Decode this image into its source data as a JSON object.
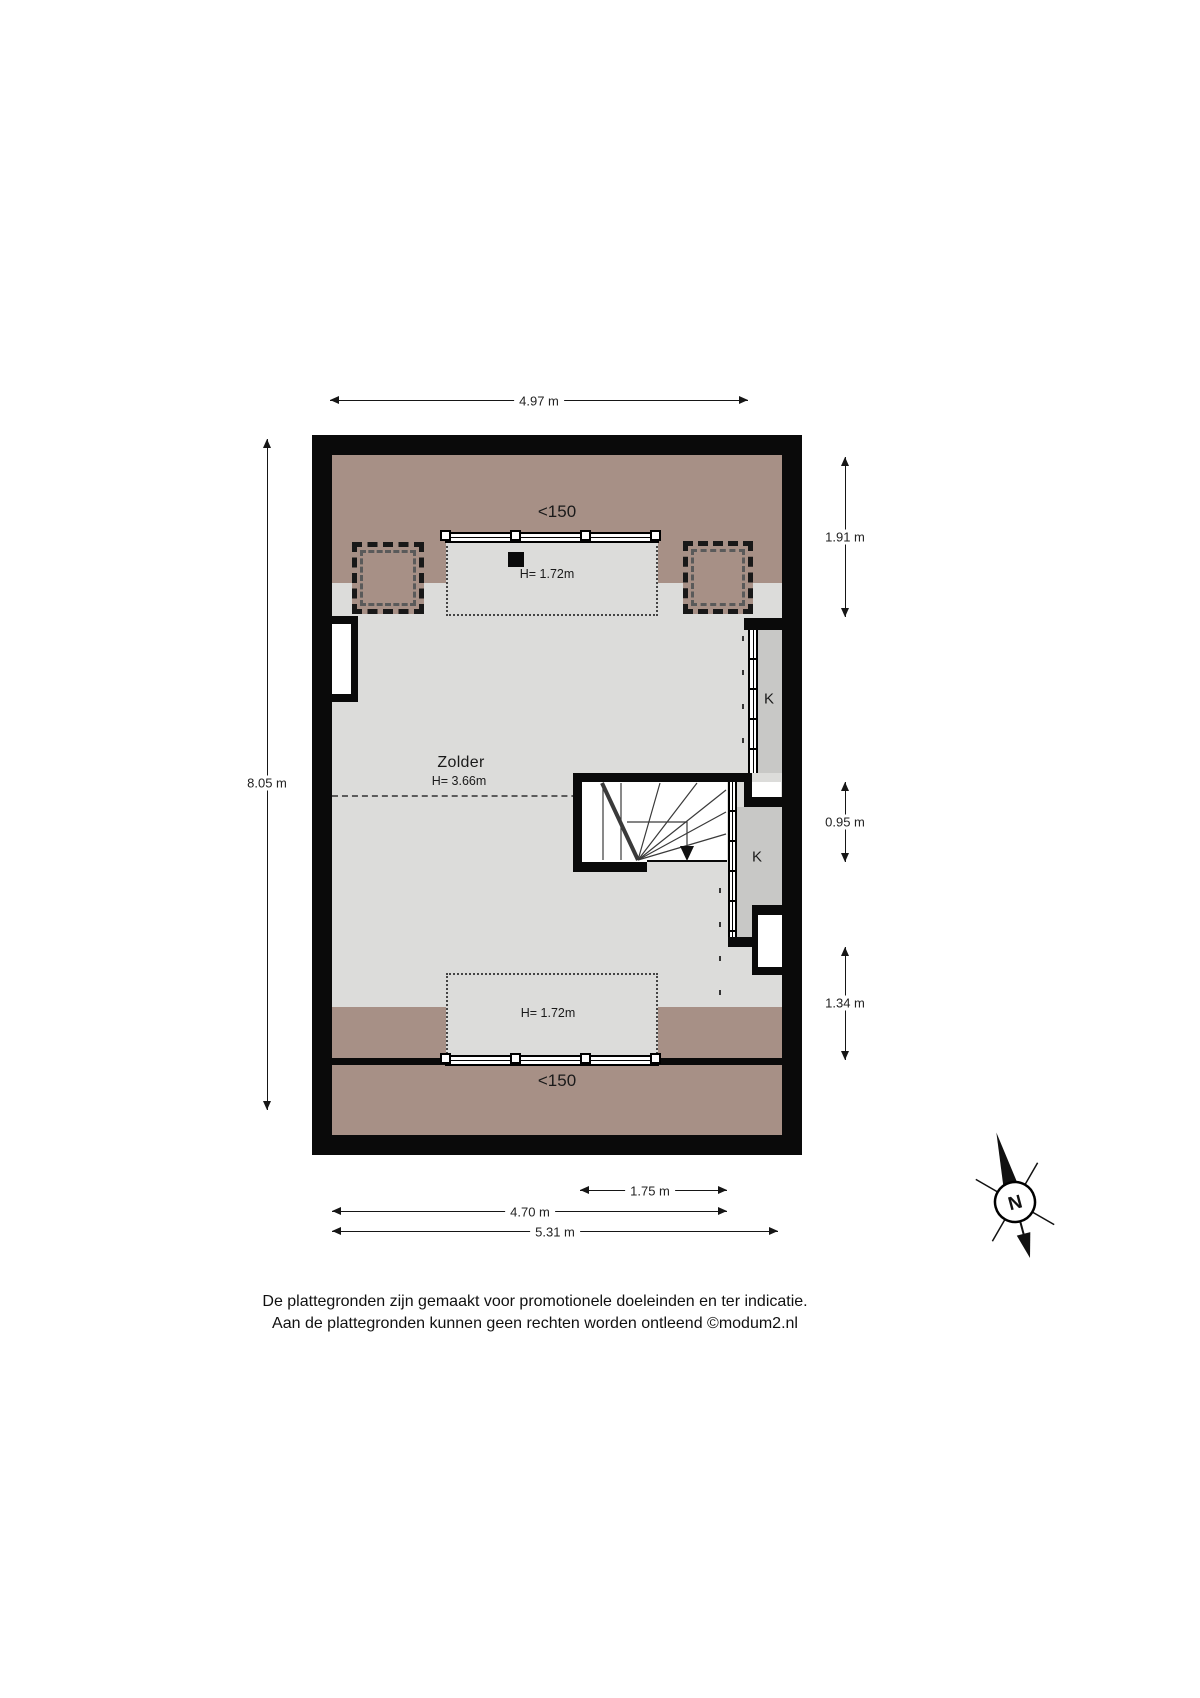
{
  "floorplan": {
    "room_label": "Zolder",
    "room_height": "H= 3.66m",
    "headroom_note_top": "<150",
    "headroom_note_bottom": "<150",
    "dormer_height_top": "H= 1.72m",
    "dormer_height_bottom": "H= 1.72m",
    "closet_label_upper": "K",
    "closet_label_lower": "K",
    "colors": {
      "wall": "#0a0a0a",
      "floor": "#dcdcda",
      "low_headroom_zone": "#a79086",
      "closet": "#c8c8c6",
      "dimension_text": "#222222"
    }
  },
  "dimensions": {
    "top_width": "4.97 m",
    "left_height": "8.05 m",
    "right_upper": "1.91 m",
    "right_middle": "0.95 m",
    "right_lower": "1.34 m",
    "bottom_window": "1.75 m",
    "bottom_inner": "4.70 m",
    "bottom_outer": "5.31 m"
  },
  "compass": {
    "north": "N"
  },
  "footer": {
    "line1": "De plattegronden zijn gemaakt voor promotionele doeleinden en ter indicatie.",
    "line2": "Aan de plattegronden kunnen geen rechten worden ontleend ©modum2.nl"
  }
}
